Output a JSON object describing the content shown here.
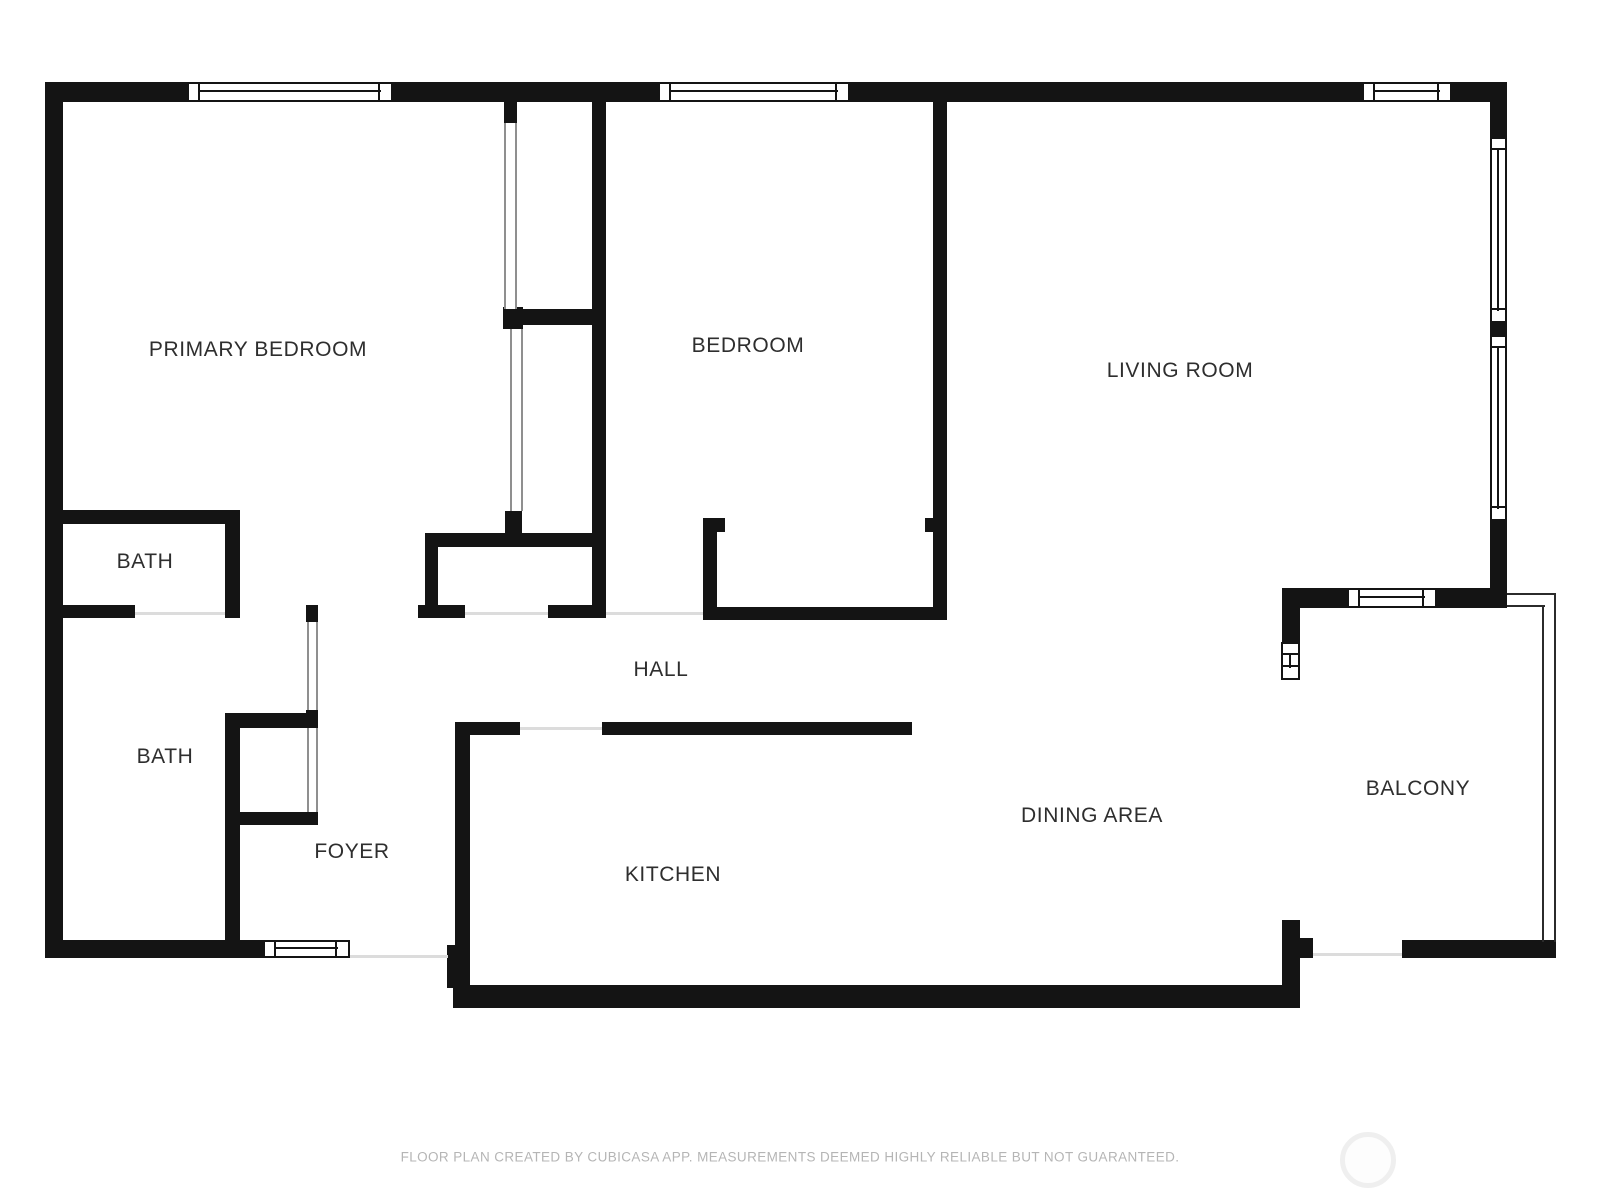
{
  "plan_title": "Floor plan",
  "rooms": {
    "primary_bedroom": "PRIMARY BEDROOM",
    "bedroom": "BEDROOM",
    "living_room": "LIVING ROOM",
    "bath_upper": "BATH",
    "bath_lower": "BATH",
    "hall": "HALL",
    "foyer": "FOYER",
    "kitchen": "KITCHEN",
    "dining_area": "DINING AREA",
    "balcony": "BALCONY"
  },
  "footer": {
    "disclaimer": "FLOOR PLAN CREATED BY CUBICASA APP. MEASUREMENTS DEEMED HIGHLY RELIABLE BUT NOT GUARANTEED."
  },
  "colors": {
    "wall": "#141414",
    "label_text": "#2e2e2e",
    "footer_text": "#b5b5b5",
    "slider_line": "#8f8f8f",
    "threshold_line": "#dcdcdc",
    "watermark_ring": "#efefef"
  }
}
